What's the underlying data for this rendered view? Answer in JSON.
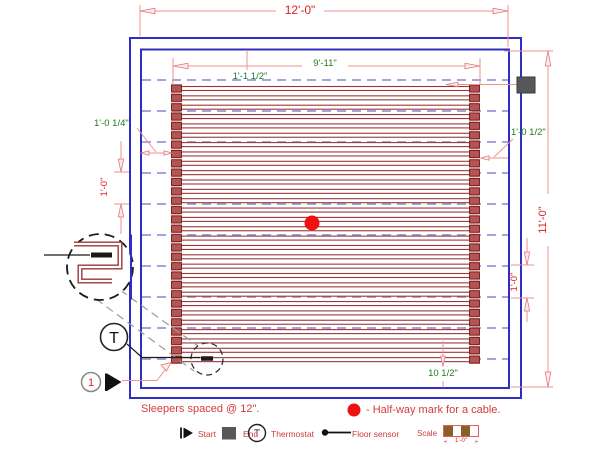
{
  "dimensions": {
    "room_width": "12'-0\"",
    "room_height": "11'-0\"",
    "mat_width": "9'-11\"",
    "top_margin": "1'-1 1/2\"",
    "left_margin": "1'-0 1/4\"",
    "right_margin": "1'-0 1/2\"",
    "bottom_margin": "10 1/2\"",
    "sleeper_gap_left": "1'-0\"",
    "sleeper_gap_right": "1'-0\""
  },
  "notes": {
    "sleepers": "Sleepers spaced @ 12\".",
    "halfway": "- Half-way mark for a cable."
  },
  "markers": {
    "start_number": "1",
    "thermostat_letter": "T",
    "legend_thermostat_letter": "T"
  },
  "legend": {
    "start": "Start",
    "end": "End",
    "thermostat": "Thermostat",
    "floor_sensor": "Floor sensor",
    "scale": "Scale",
    "scale_length": "1'-0\""
  },
  "drawing": {
    "cable_runs": 30,
    "sleeper_lines": 10
  },
  "colors": {
    "wall_blue": "#2e2ec4",
    "cable_red": "#9a3838",
    "cap_red": "#b35555",
    "sleeper_lavender": "#9898dc",
    "dimension_pink": "#ef9292",
    "text_red": "#e02020",
    "text_green": "#1e7d1e",
    "halfway_dot": "#ee1111"
  }
}
